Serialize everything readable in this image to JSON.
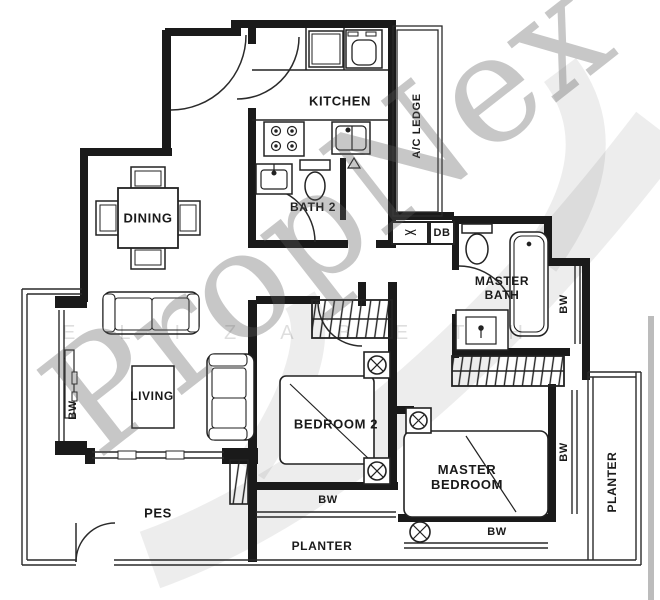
{
  "plan": {
    "title_labels": {
      "kitchen": "KITCHEN",
      "dining": "DINING",
      "bath2": "BATH 2",
      "ac_ledge": "A/C LEDGE",
      "db": "DB",
      "master_bath": "MASTER BATH",
      "living": "LIVING",
      "bedroom2": "BEDROOM 2",
      "master_bedroom": "MASTER BEDROOM",
      "pes": "PES",
      "planter": "PLANTER",
      "bw": "BW"
    },
    "symbols": {
      "bowtie": "><"
    },
    "watermark": {
      "brand": "PropNex",
      "name": "ELIZABETH"
    },
    "colors": {
      "wall": "#1a1a1a",
      "line": "#2a2a2a",
      "background": "#ffffff",
      "watermark_gray": "#9a9a9a"
    }
  }
}
